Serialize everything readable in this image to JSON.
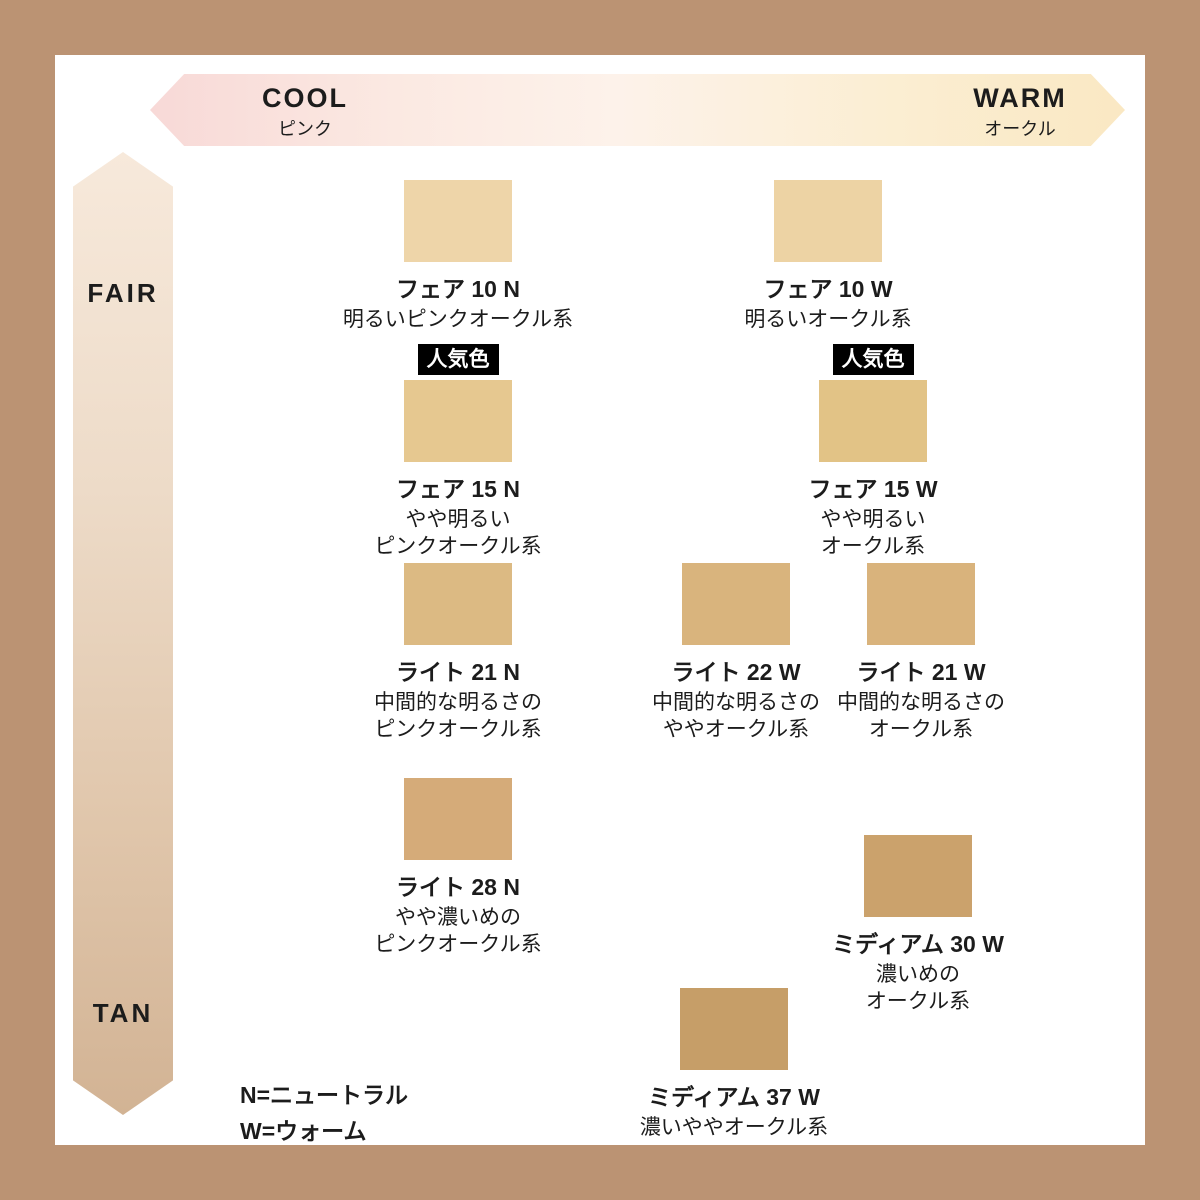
{
  "frame_color": "#bb9373",
  "axes": {
    "horizontal": {
      "left_label": "COOL",
      "left_sublabel": "ピンク",
      "right_label": "WARM",
      "right_sublabel": "オークル",
      "gradient_start": "#f8d9d7",
      "gradient_end": "#fae8c3"
    },
    "vertical": {
      "top_label": "FAIR",
      "bottom_label": "TAN",
      "gradient_start": "#f7e9db",
      "gradient_end": "#d2b394"
    }
  },
  "popular_badge_label": "人気色",
  "shades": [
    {
      "name": "フェア 10 N",
      "desc": "明るいピンクオークル系",
      "color": "#eed5a9",
      "popular": false
    },
    {
      "name": "フェア 10 W",
      "desc": "明るいオークル系",
      "color": "#edd3a4",
      "popular": false
    },
    {
      "name": "フェア 15 N",
      "desc": "やや明るい\nピンクオークル系",
      "color": "#e6c890",
      "popular": true
    },
    {
      "name": "フェア 15 W",
      "desc": "やや明るい\nオークル系",
      "color": "#e2c386",
      "popular": true
    },
    {
      "name": "ライト 21 N",
      "desc": "中間的な明るさの\nピンクオークル系",
      "color": "#dcba83",
      "popular": false
    },
    {
      "name": "ライト 22 W",
      "desc": "中間的な明るさの\nややオークル系",
      "color": "#d9b47d",
      "popular": false
    },
    {
      "name": "ライト 21 W",
      "desc": "中間的な明るさの\nオークル系",
      "color": "#d9b37c",
      "popular": false
    },
    {
      "name": "ライト 28 N",
      "desc": "やや濃いめの\nピンクオークル系",
      "color": "#d5ab79",
      "popular": false
    },
    {
      "name": "ミディアム 30 W",
      "desc": "濃いめの\nオークル系",
      "color": "#cba26c",
      "popular": false
    },
    {
      "name": "ミディアム 37 W",
      "desc": "濃いややオークル系",
      "color": "#c69e68",
      "popular": false
    }
  ],
  "legend": {
    "line1": "N=ニュートラル",
    "line2": "W=ウォーム"
  }
}
